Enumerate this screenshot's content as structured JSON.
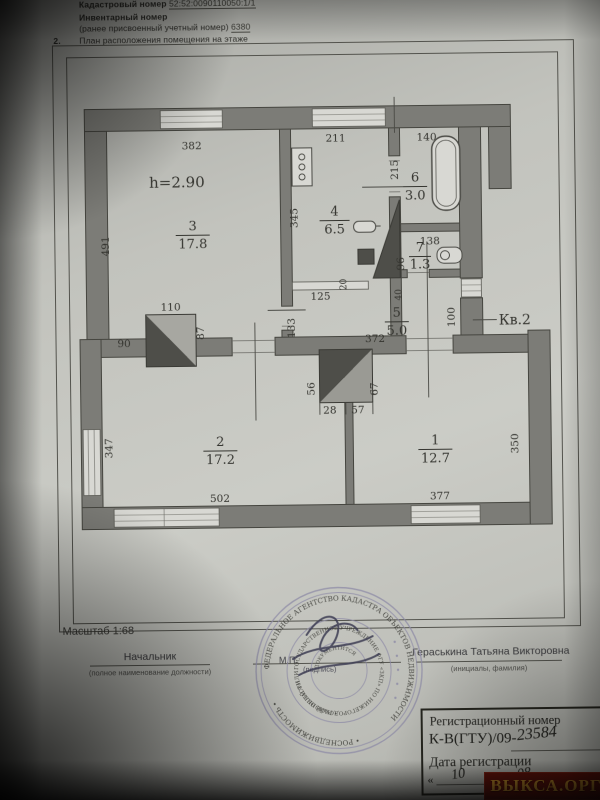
{
  "header": {
    "cadastral_label": "Кадастровый номер",
    "cadastral_value": "52:52:0090110050:1/1",
    "inventory_label": "Инвентарный номер",
    "inventory_note": "(ранее присвоенный учетный номер)",
    "inventory_value": "6380",
    "item_no": "2.",
    "item_title": "План расположения помещения на этаже"
  },
  "plan": {
    "scale_label": "Масштаб 1:68",
    "height_label": "h=2.90",
    "apartment_label": "Кв.2",
    "rooms": [
      {
        "num": "3",
        "area": "17.8"
      },
      {
        "num": "4",
        "area": "6.5"
      },
      {
        "num": "6",
        "area": "3.0"
      },
      {
        "num": "7",
        "area": "1.3"
      },
      {
        "num": "5",
        "area": "5.0"
      },
      {
        "num": "2",
        "area": "17.2"
      },
      {
        "num": "1",
        "area": "12.7"
      }
    ],
    "dims": {
      "d382": "382",
      "d211": "211",
      "d140": "140",
      "d491": "491",
      "d345": "345",
      "d215": "215",
      "d138": "138",
      "d96": "96",
      "d110": "110",
      "d87": "87",
      "d90": "90",
      "d125": "125",
      "d133": "133",
      "d20": "20",
      "d40": "40",
      "d372": "372",
      "d100": "100",
      "d56": "56",
      "d28": "28",
      "d57": "57",
      "d67": "67",
      "d347": "347",
      "d502": "502",
      "d377": "377",
      "d350": "350"
    }
  },
  "signature": {
    "left_title": "Начальник",
    "left_note": "(полное наименование должности)",
    "right_name": "Гераськина Татьяна Викторовна",
    "right_note": "(инициалы, фамилия)",
    "mp": "М.П.",
    "sign_note": "(подпись)"
  },
  "stamp": {
    "ring_outer_a": "ФЕДЕРАЛЬНОЕ АГЕНТСТВО КАДАСТРА ОБЪЕКТОВ НЕДВИЖИМОСТИ",
    "ring_outer_b": "• РОСНЕДВИЖИМОСТЬ •",
    "ring_mid_a": "ГОСУДАРСТВЕННОЕ УЧРЕЖДЕНИЕ ФГУ «ЗКП» ПО НИЖЕГОРОДСКОЙ ОБЛАСТИ",
    "ring_mid_b": "• РАЙОННЫЙ ФИЛИАЛ •",
    "center": "ДОКУМЕНТИТСЯ"
  },
  "registration": {
    "title": "Регистрационный номер",
    "prefix": "К-В(ГТУ)/09-",
    "number": "23584",
    "date_label": "Дата регистрации",
    "open_quote": "«",
    "day": "10",
    "close_quote": "»",
    "month": "08",
    "year": "2009г."
  },
  "watermark": {
    "text": "ВЫКСА.ОРГ"
  },
  "colors": {
    "paper": "#c6c7c1",
    "wall": "#7c7c77",
    "ink": "#34342f",
    "stamp_ink": "#8d8aa6",
    "watermark_bg": "#671209",
    "watermark_fg": "#d3972c"
  }
}
